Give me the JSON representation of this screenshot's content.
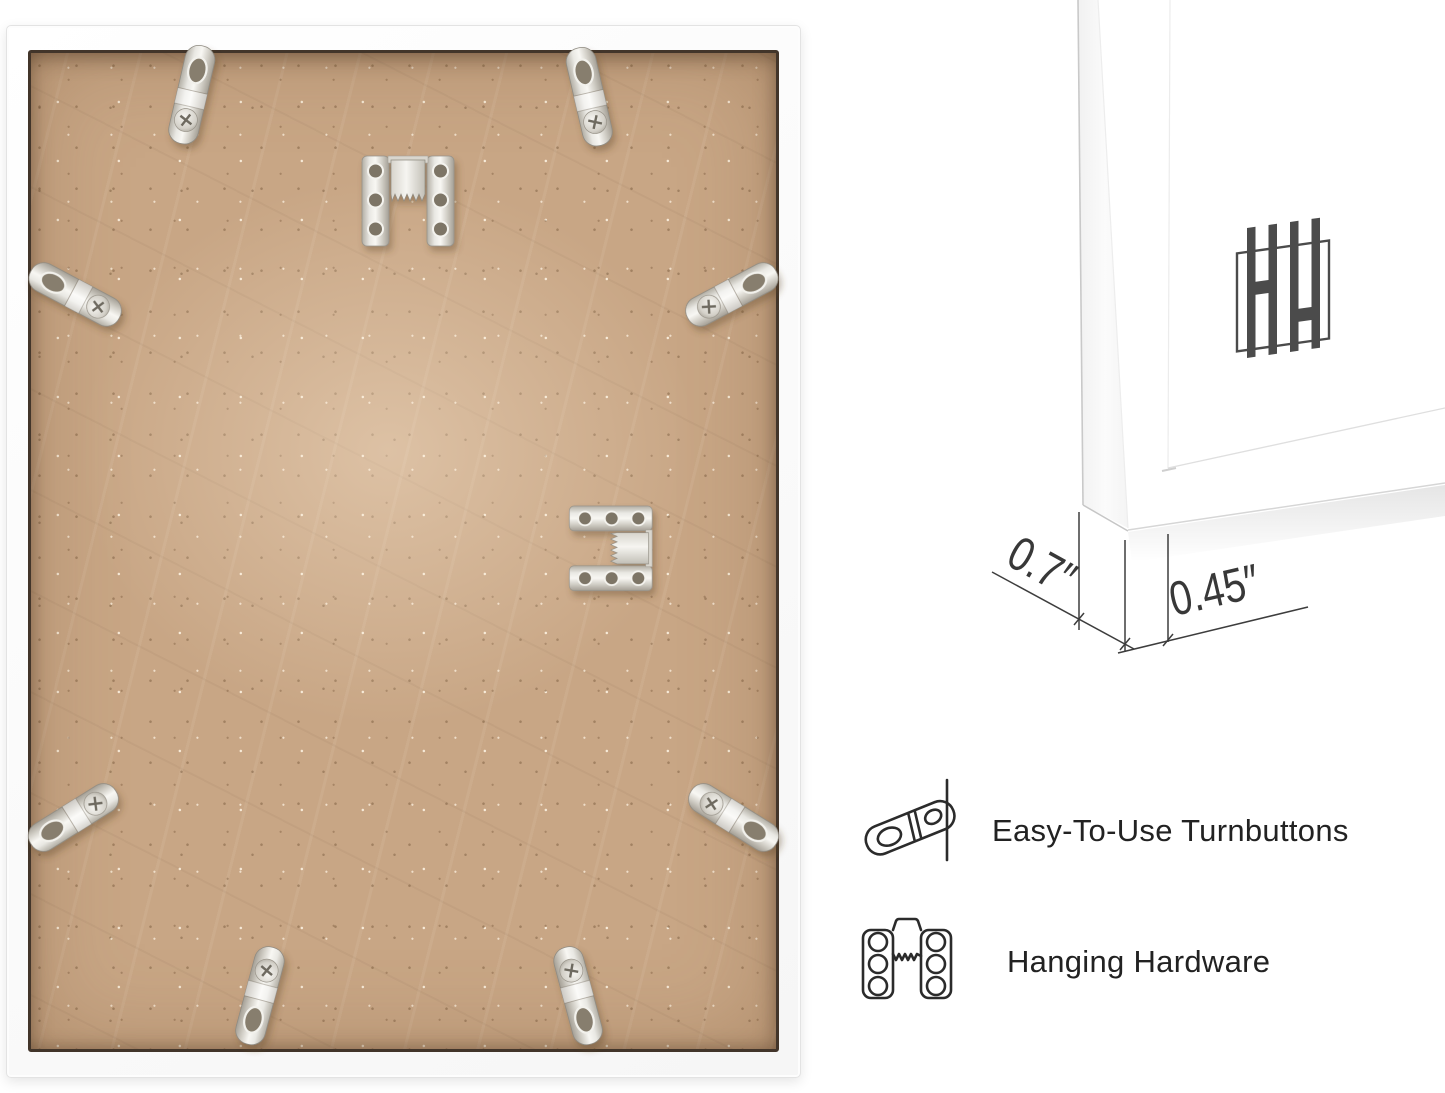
{
  "page": {
    "title": "Picture frame back — product infographic",
    "background": "#ffffff"
  },
  "photo": {
    "subject": "frame-back-with-mdf-board",
    "frame_color": "#fafafa",
    "board_color": "#c8a685",
    "board_edge_color": "#42352a",
    "hardware": {
      "turnbutton_count": 8,
      "sawtooth_hanger_count": 2,
      "metal_color": "#dcdad3"
    }
  },
  "corner": {
    "logo": {
      "name": "brand-monogram-hh",
      "color": "#4b4b4b"
    },
    "dimensions": {
      "depth_label": "0.7″",
      "face_label": "0.45″",
      "line_color": "#3d3d3d"
    }
  },
  "features": {
    "text_color": "#222222",
    "items": [
      {
        "icon": "turnbutton-icon",
        "label": "Easy-To-Use Turnbuttons"
      },
      {
        "icon": "sawtooth-hanger-icon",
        "label": "Hanging Hardware"
      }
    ]
  }
}
